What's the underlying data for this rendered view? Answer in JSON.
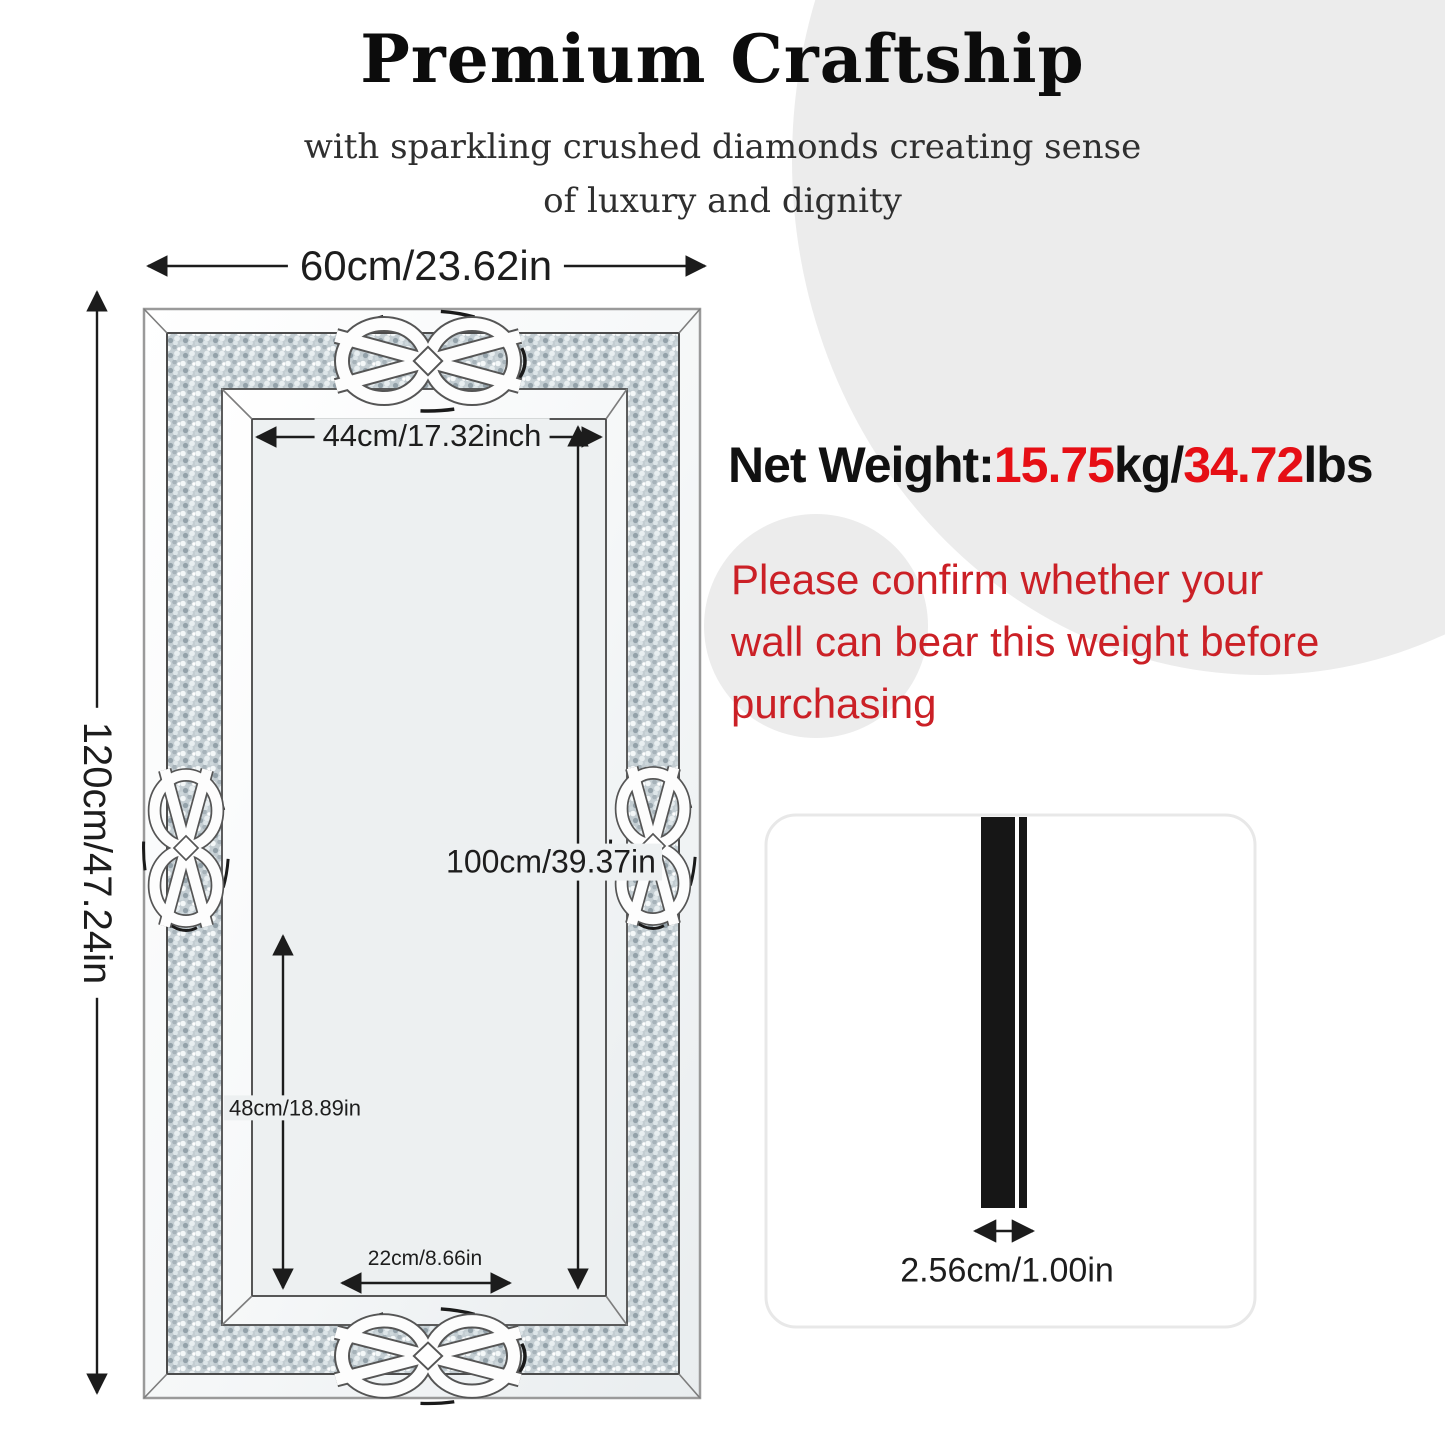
{
  "header": {
    "title": "Premium Craftship",
    "subtitle_lines": [
      "with sparkling crushed diamonds creating sense",
      "of luxury and dignity"
    ]
  },
  "dimensions": {
    "outer_width": "60cm/23.62in",
    "outer_height": "120cm/47.24in",
    "inner_width": "44cm/17.32inch",
    "inner_height": "100cm/39.37in",
    "lower_inner_height": "48cm/18.89in",
    "lower_inner_width": "22cm/8.66in"
  },
  "weight": {
    "segments": [
      {
        "text": "Net Weight:",
        "emphasis": false
      },
      {
        "text": "15.75",
        "emphasis": true
      },
      {
        "text": "kg/",
        "emphasis": false
      },
      {
        "text": "34.72",
        "emphasis": true
      },
      {
        "text": "lbs",
        "emphasis": false
      }
    ],
    "base_color": "#111111",
    "emphasis_color": "#e60f15"
  },
  "warning": {
    "color": "#cb2026",
    "lines": [
      "Please confirm whether your",
      "wall can bear this weight before",
      "purchasing"
    ]
  },
  "side_view": {
    "thickness": "2.56cm/1.00in"
  },
  "colors": {
    "background_circle": "#ececec",
    "mirror_surface": "#edf0f1",
    "crushed_band_base": "#c3cdd2",
    "dimension_line": "#1c1c1c"
  }
}
